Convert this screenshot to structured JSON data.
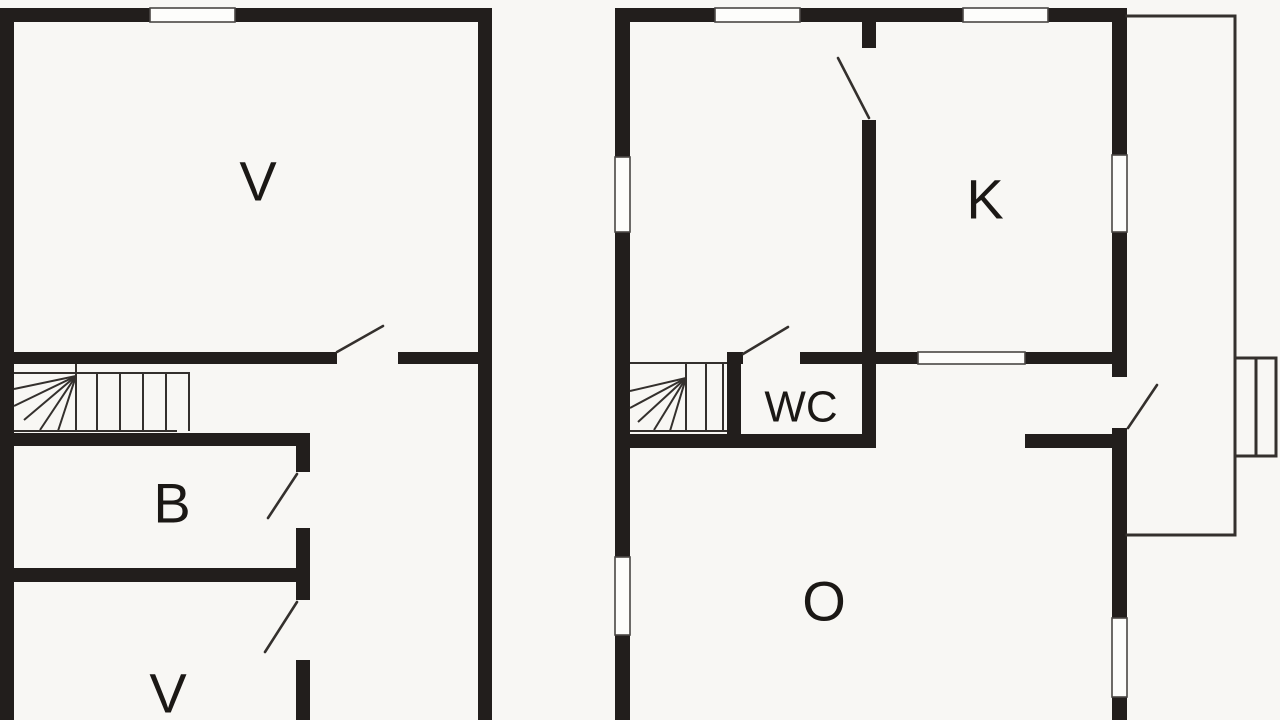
{
  "page": {
    "background": "#f8f7f4",
    "width": 1280,
    "height": 720
  },
  "plan": {
    "colors": {
      "wall": "#221e1c",
      "thin_line": "#34302d",
      "door_line": "#34302d",
      "window_fill": "#fdfdfb",
      "window_stroke": "#4a4744",
      "label": "#1b1815",
      "background": "#f8f7f4"
    },
    "rooms": [
      {
        "name": "room-label-v-upper-left",
        "label": "V",
        "x": 258,
        "y": 181,
        "font": 56
      },
      {
        "name": "room-label-b",
        "label": "B",
        "x": 172,
        "y": 503,
        "font": 56
      },
      {
        "name": "room-label-v-lower-left",
        "label": "V",
        "x": 168,
        "y": 693,
        "font": 56
      },
      {
        "name": "room-label-k",
        "label": "K",
        "x": 985,
        "y": 199,
        "font": 56
      },
      {
        "name": "room-label-wc",
        "label": "WC",
        "x": 801,
        "y": 407,
        "font": 44
      },
      {
        "name": "room-label-o",
        "label": "O",
        "x": 824,
        "y": 601,
        "font": 56
      }
    ],
    "walls": [
      [
        0,
        8,
        14,
        712
      ],
      [
        0,
        8,
        492,
        14
      ],
      [
        478,
        8,
        14,
        712
      ],
      [
        0,
        352,
        337,
        12
      ],
      [
        398,
        352,
        94,
        12
      ],
      [
        0,
        433,
        310,
        13
      ],
      [
        296,
        446,
        14,
        26
      ],
      [
        296,
        528,
        14,
        40
      ],
      [
        0,
        568,
        310,
        14
      ],
      [
        296,
        582,
        14,
        18
      ],
      [
        296,
        660,
        14,
        60
      ],
      [
        615,
        8,
        15,
        149
      ],
      [
        615,
        232,
        15,
        325
      ],
      [
        615,
        635,
        15,
        85
      ],
      [
        615,
        8,
        100,
        14
      ],
      [
        800,
        8,
        163,
        14
      ],
      [
        1048,
        8,
        79,
        14
      ],
      [
        1112,
        8,
        15,
        147
      ],
      [
        1112,
        232,
        15,
        145
      ],
      [
        1112,
        428,
        15,
        190
      ],
      [
        1112,
        697,
        15,
        23
      ],
      [
        862,
        22,
        14,
        26
      ],
      [
        862,
        120,
        14,
        328
      ],
      [
        876,
        352,
        42,
        12
      ],
      [
        1025,
        352,
        87,
        12
      ],
      [
        727,
        352,
        16,
        12
      ],
      [
        800,
        352,
        62,
        12
      ],
      [
        727,
        352,
        14,
        96
      ],
      [
        630,
        434,
        246,
        14
      ],
      [
        1025,
        434,
        87,
        14
      ]
    ],
    "windows": [
      [
        150,
        8,
        85,
        14
      ],
      [
        715,
        8,
        85,
        14
      ],
      [
        963,
        8,
        85,
        14
      ],
      [
        615,
        157,
        15,
        75
      ],
      [
        615,
        557,
        15,
        78
      ],
      [
        1112,
        155,
        15,
        77
      ],
      [
        1112,
        618,
        15,
        79
      ],
      [
        918,
        352,
        107,
        12
      ]
    ],
    "door_leaves": [
      [
        337,
        352,
        383,
        326
      ],
      [
        268,
        518,
        297,
        474
      ],
      [
        265,
        652,
        297,
        602
      ],
      [
        838,
        58,
        869,
        118
      ],
      [
        743,
        354,
        788,
        327
      ],
      [
        1128,
        428,
        1157,
        385
      ]
    ],
    "annex_lines": [
      [
        1127,
        16,
        1235,
        16
      ],
      [
        1235,
        16,
        1235,
        535
      ],
      [
        1127,
        535,
        1235,
        535
      ],
      [
        1235,
        358,
        1276,
        358
      ],
      [
        1276,
        358,
        1276,
        456
      ],
      [
        1235,
        456,
        1276,
        456
      ],
      [
        1256,
        358,
        1256,
        456
      ]
    ],
    "stair_lines": [
      [
        14,
        373,
        190,
        373
      ],
      [
        14,
        431,
        177,
        431
      ],
      [
        76,
        364,
        76,
        431
      ],
      [
        97,
        373,
        97,
        431
      ],
      [
        120,
        373,
        120,
        431
      ],
      [
        143,
        373,
        143,
        431
      ],
      [
        166,
        373,
        166,
        431
      ],
      [
        189,
        373,
        189,
        431
      ],
      [
        76,
        376,
        14,
        389
      ],
      [
        76,
        376,
        14,
        406
      ],
      [
        76,
        376,
        24,
        420
      ],
      [
        76,
        376,
        40,
        430
      ],
      [
        76,
        376,
        58,
        431
      ],
      [
        630,
        363,
        727,
        363
      ],
      [
        630,
        431,
        727,
        431
      ],
      [
        686,
        363,
        686,
        431
      ],
      [
        706,
        363,
        706,
        431
      ],
      [
        723,
        363,
        723,
        431
      ],
      [
        686,
        378,
        630,
        391
      ],
      [
        686,
        378,
        630,
        408
      ],
      [
        686,
        378,
        638,
        422
      ],
      [
        686,
        378,
        654,
        430
      ],
      [
        686,
        378,
        670,
        431
      ]
    ]
  }
}
